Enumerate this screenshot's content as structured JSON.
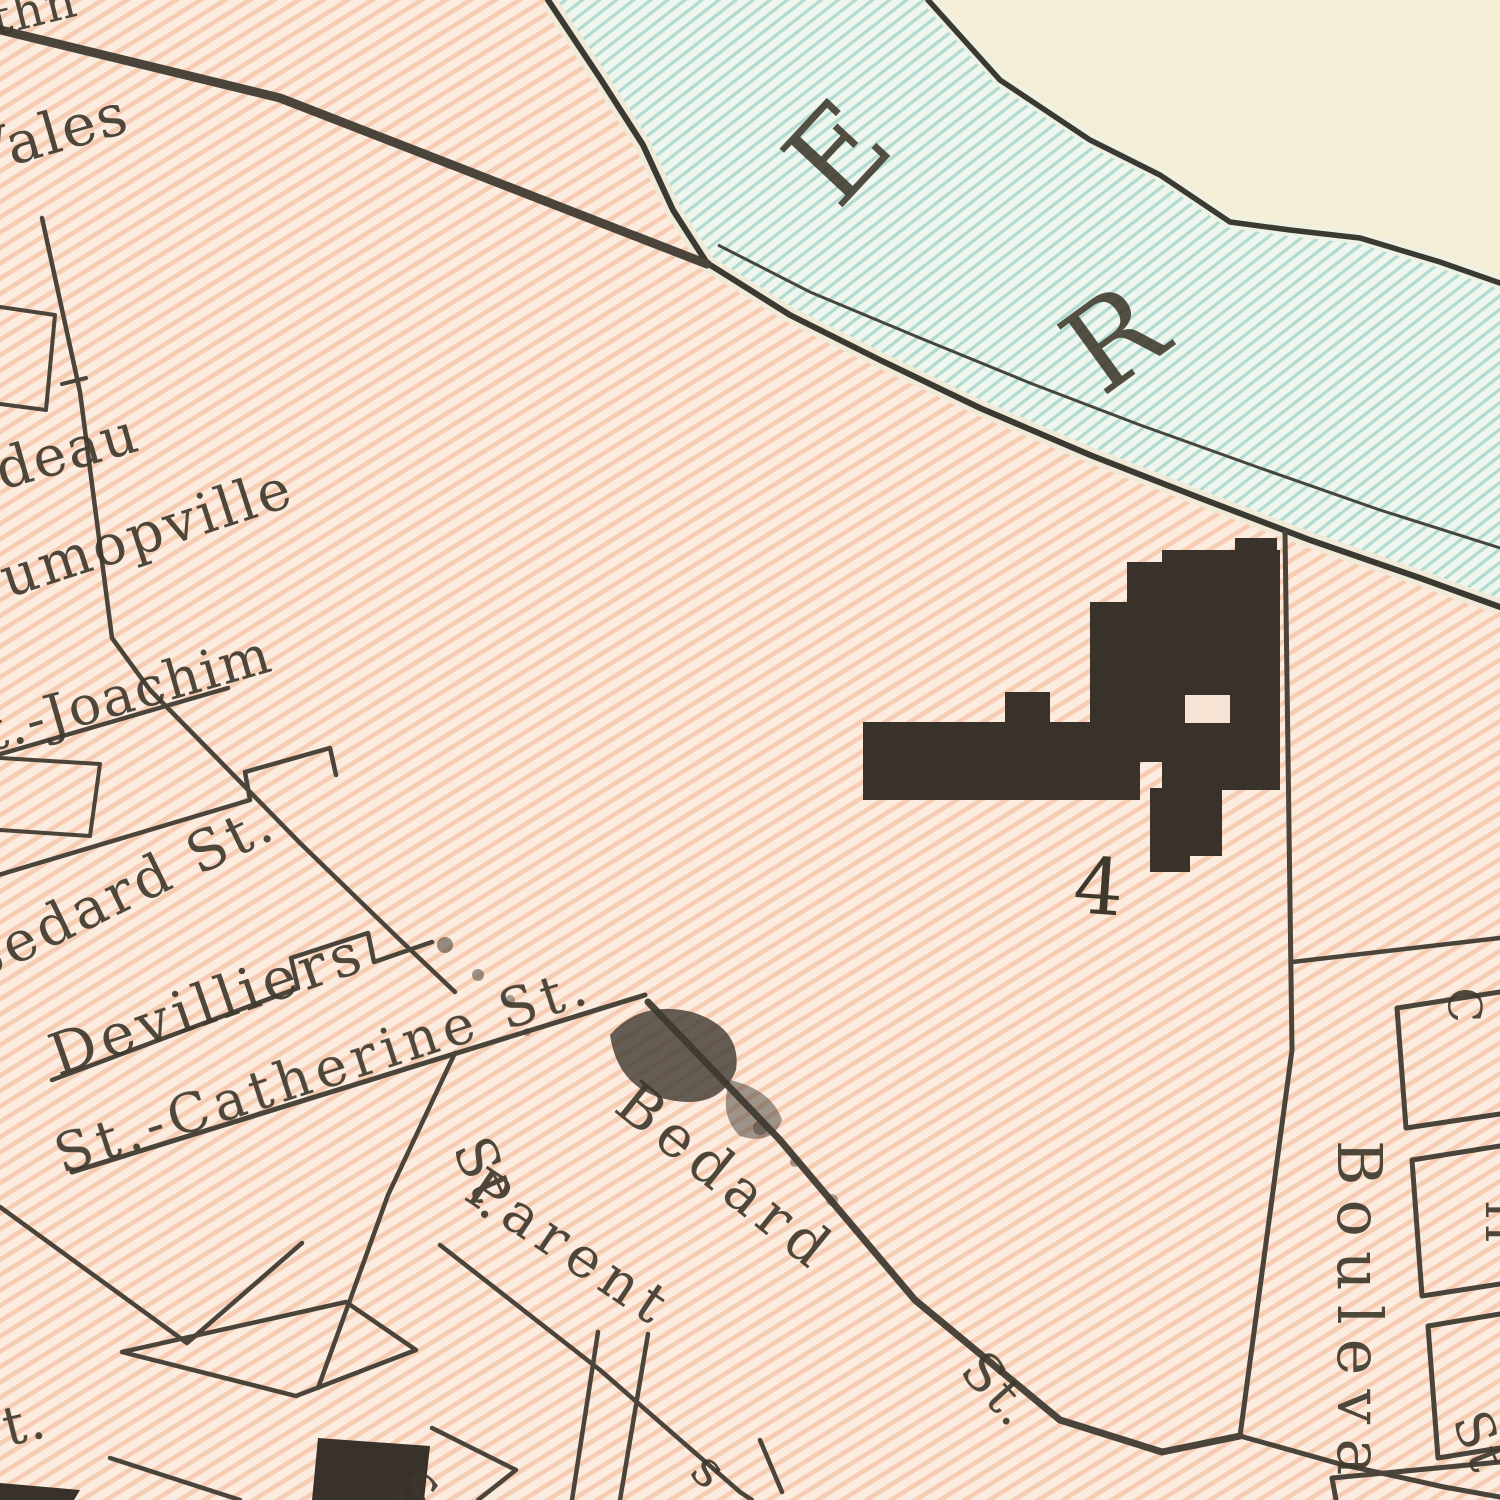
{
  "map": {
    "kind": "vintage-scanned-street-map-crop",
    "palette": {
      "city_fill": "#fcecdf",
      "city_hatch": "#f5c7ab",
      "water_fill": "#eef6ee",
      "water_hatch": "#abd9d0",
      "far_bank": "#f5eed7",
      "ink": "#3f382c",
      "street_line": "#4a443a",
      "building_fill": "#38322a"
    },
    "river": {
      "letters": [
        {
          "char": "E"
        },
        {
          "char": "R"
        }
      ]
    },
    "building": {
      "number": "4"
    },
    "labels": [
      {
        "id": "fragment-top-left",
        "text": "thn"
      },
      {
        "id": "vales",
        "text": "Vales"
      },
      {
        "id": "deau",
        "text": "deau"
      },
      {
        "id": "umopville",
        "text": "umopville"
      },
      {
        "id": "st-joachim",
        "text": "t.-Joachim"
      },
      {
        "id": "bedard-st",
        "text": "Bedard St."
      },
      {
        "id": "devilliers",
        "text": "Devilliers"
      },
      {
        "id": "st-catherine-st",
        "text": "St.-Catherine St."
      },
      {
        "id": "bedard",
        "text": "Bedard"
      },
      {
        "id": "bedard-st-suffix",
        "text": "St."
      },
      {
        "id": "parent",
        "text": "Parent"
      },
      {
        "id": "st-vertical",
        "text": "St."
      },
      {
        "id": "boulevard",
        "text": "Bouleva"
      },
      {
        "id": "st-bottom-right",
        "text": "St"
      },
      {
        "id": "t-bottom-left",
        "text": "t."
      },
      {
        "id": "fragment-c",
        "text": "C"
      },
      {
        "id": "fragment-h",
        "text": "H"
      },
      {
        "id": "fragment-s-1",
        "text": "S"
      },
      {
        "id": "fragment-s-2",
        "text": "s"
      }
    ]
  }
}
